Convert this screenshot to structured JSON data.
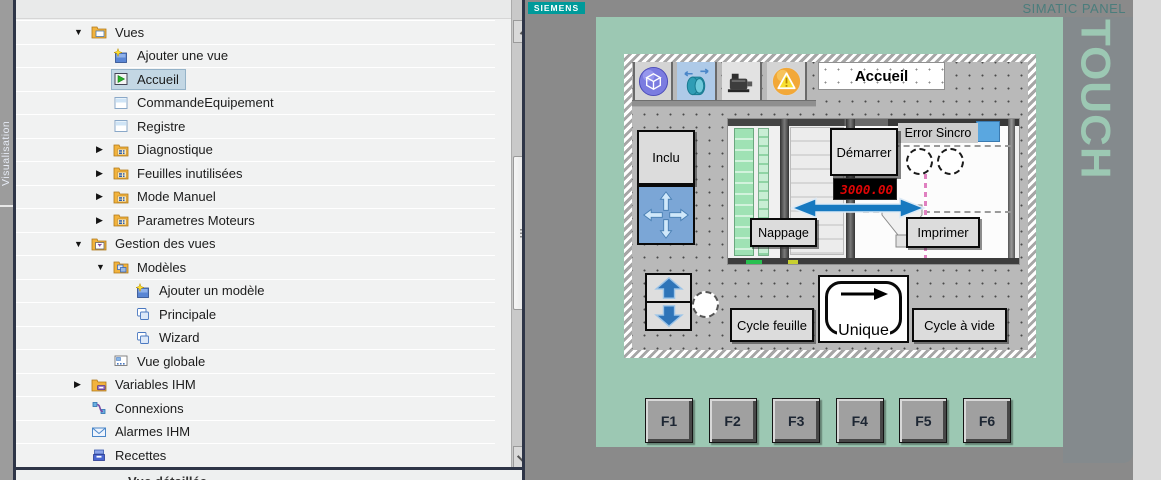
{
  "sidebar_rail": {
    "label": "Visualisation"
  },
  "project_tree": {
    "items": [
      {
        "label": "Vues",
        "level": 0,
        "expander": "open",
        "icon": "screens-folder-icon",
        "selected": false
      },
      {
        "label": "Ajouter une vue",
        "level": 1,
        "expander": "none",
        "icon": "add-screen-icon",
        "selected": false
      },
      {
        "label": "Accueil",
        "level": 1,
        "expander": "none",
        "icon": "start-screen-icon",
        "selected": true
      },
      {
        "label": "CommandeEquipement",
        "level": 1,
        "expander": "none",
        "icon": "screen-icon",
        "selected": false
      },
      {
        "label": "Registre",
        "level": 1,
        "expander": "none",
        "icon": "screen-icon",
        "selected": false
      },
      {
        "label": "Diagnostique",
        "level": 1,
        "expander": "closed",
        "icon": "screen-group-icon",
        "selected": false
      },
      {
        "label": "Feuilles inutilisées",
        "level": 1,
        "expander": "closed",
        "icon": "screen-group-icon",
        "selected": false
      },
      {
        "label": "Mode Manuel",
        "level": 1,
        "expander": "closed",
        "icon": "screen-group-icon",
        "selected": false
      },
      {
        "label": "Parametres Moteurs",
        "level": 1,
        "expander": "closed",
        "icon": "screen-group-icon",
        "selected": false
      },
      {
        "label": "Gestion des vues",
        "level": 0,
        "expander": "open",
        "icon": "screen-mgmt-icon",
        "selected": false
      },
      {
        "label": "Modèles",
        "level": 1,
        "expander": "open",
        "icon": "templates-folder-icon",
        "selected": false
      },
      {
        "label": "Ajouter un modèle",
        "level": 2,
        "expander": "none",
        "icon": "add-template-icon",
        "selected": false
      },
      {
        "label": "Principale",
        "level": 2,
        "expander": "none",
        "icon": "template-icon",
        "selected": false
      },
      {
        "label": "Wizard",
        "level": 2,
        "expander": "none",
        "icon": "template-icon",
        "selected": false
      },
      {
        "label": "Vue globale",
        "level": 1,
        "expander": "none",
        "icon": "global-screen-icon",
        "selected": false
      },
      {
        "label": "Variables IHM",
        "level": 0,
        "expander": "closed",
        "icon": "hmi-tags-folder-icon",
        "selected": false
      },
      {
        "label": "Connexions",
        "level": 0,
        "expander": "none",
        "icon": "connections-icon",
        "selected": false
      },
      {
        "label": "Alarmes IHM",
        "level": 0,
        "expander": "none",
        "icon": "hmi-alarms-icon",
        "selected": false
      },
      {
        "label": "Recettes",
        "level": 0,
        "expander": "none",
        "icon": "recipes-icon",
        "selected": false
      }
    ]
  },
  "detail_panel": {
    "title": "Vue détaillée"
  },
  "device": {
    "brand": "SIEMENS",
    "model_label": "SIMATIC PANEL",
    "family_label": "TOUCH",
    "function_keys": [
      "F1",
      "F2",
      "F3",
      "F4",
      "F5",
      "F6"
    ]
  },
  "hmi_screen": {
    "title": "Accueil",
    "toolbar_icons": [
      "view-3d-icon",
      "rotation-icon",
      "motor-icon",
      "alarms-icon"
    ],
    "buttons": {
      "inclu": "Inclu",
      "demarrer": "Démarrer",
      "nappage": "Nappage",
      "imprimer": "Imprimer",
      "cycle_feuille": "Cycle feuille",
      "unique": "Unique",
      "cycle_a_vide": "Cycle à vide"
    },
    "numeric_display": {
      "value": "3000.00",
      "color": "#e00505",
      "background": "#000000"
    },
    "error_label": "Error Sincro"
  },
  "colors": {
    "siemens_teal": "#009a9a",
    "bezel_green": "#9cc8b3",
    "canvas_gray": "#8a8a8a",
    "screen_gray": "#b9b9b9",
    "selection_blue": "#c3d7e4",
    "display_red": "#e00505"
  }
}
